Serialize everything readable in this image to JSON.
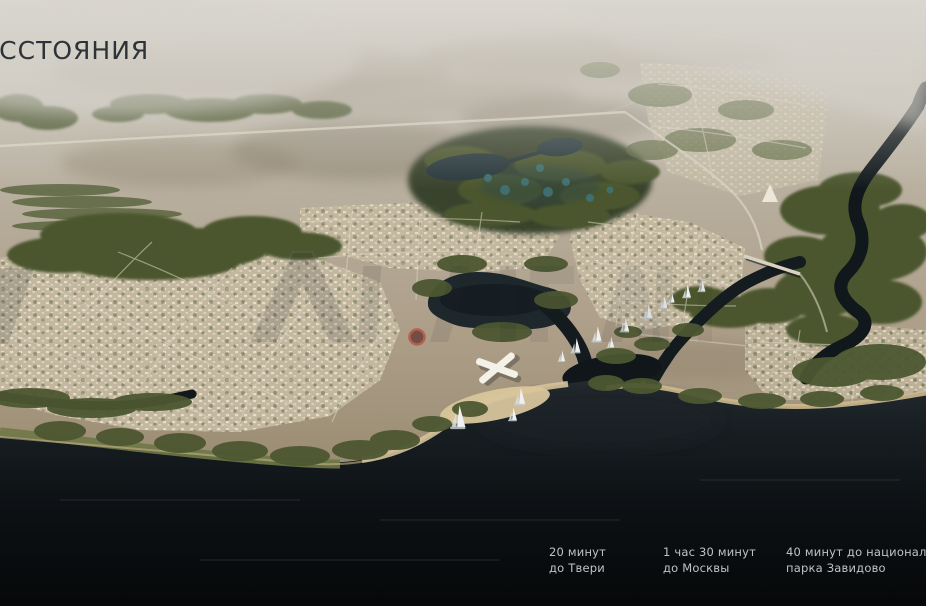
{
  "slide": {
    "title": "РАССТОЯНИЯ",
    "distance_labels": [
      {
        "line1": "20 минут",
        "line2": "до Твери"
      },
      {
        "line1": "1 час 30 минут",
        "line2": "до Москвы"
      },
      {
        "line1": "40 минут до национального",
        "line2": "парка Завидово"
      }
    ]
  },
  "theme": {
    "title-color": "#2e3338",
    "label-color": "#c0c3c5",
    "haze": "#d6d3cc",
    "field": "#b3a794",
    "forest": "#4c572f",
    "sand": "#d3bf97",
    "water-dark": "#0b0e10",
    "water-mid": "#1a2125",
    "accent-teal": "#3f7276",
    "roof-red": "#b75b4d"
  }
}
